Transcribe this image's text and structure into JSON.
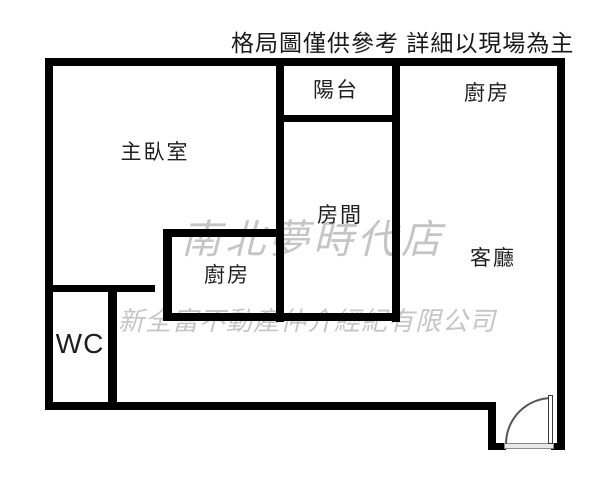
{
  "title": "格局圖僅供參考 詳細以現場為主",
  "rooms": [
    {
      "id": "master-bedroom",
      "label": "主臥室"
    },
    {
      "id": "balcony",
      "label": "陽台"
    },
    {
      "id": "kitchen-top-right",
      "label": "廚房"
    },
    {
      "id": "bedroom-2",
      "label": "房間"
    },
    {
      "id": "kitchen-middle",
      "label": "廚房"
    },
    {
      "id": "living-room",
      "label": "客廳"
    },
    {
      "id": "toilet",
      "label": "WC"
    }
  ],
  "watermarks": {
    "store_name": "南北夢時代店",
    "company_name": "新全富不動產仲介經紀有限公司"
  },
  "colors": {
    "wall": "#000000",
    "background": "#ffffff",
    "watermark": "#c5c5c5",
    "text": "#1a1a1a"
  }
}
